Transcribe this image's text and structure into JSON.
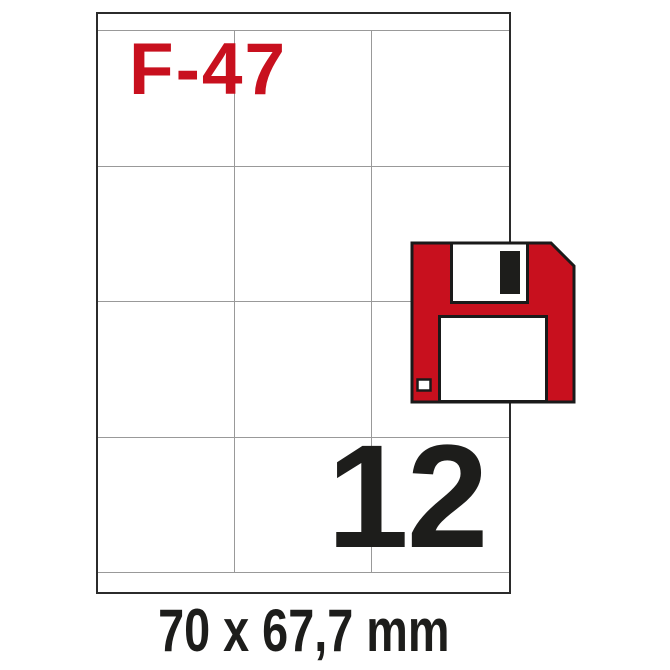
{
  "product": {
    "code": "F-47",
    "labels_per_sheet": "12",
    "label_size": "70 x 67,7 mm"
  },
  "sheet": {
    "columns": 3,
    "rows": 4
  },
  "icon": "floppy-disk-icon",
  "colors": {
    "accent_red": "#c8101e",
    "outline_black": "#1a1a1a",
    "grid_gray": "#999999",
    "border_dark": "#2b2b2b"
  }
}
